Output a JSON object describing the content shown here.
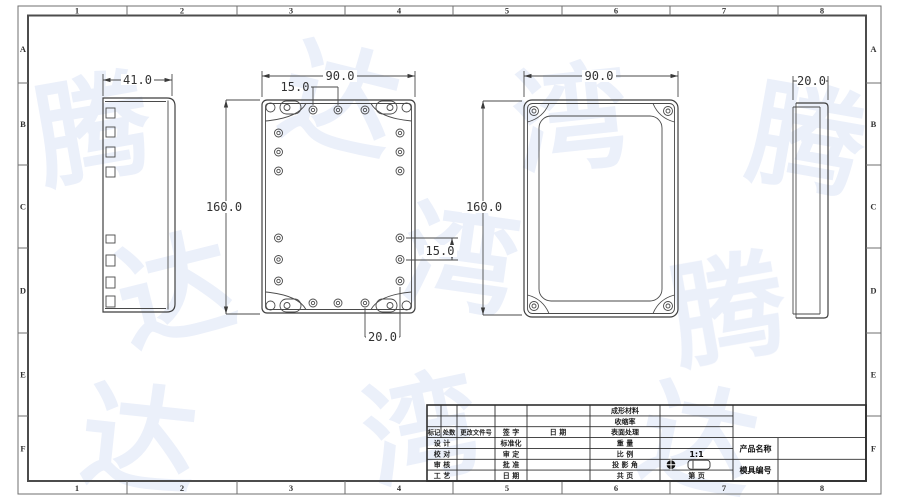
{
  "frame": {
    "columns": [
      "1",
      "2",
      "3",
      "4",
      "5",
      "6",
      "7",
      "8"
    ],
    "rows": [
      "A",
      "B",
      "C",
      "D",
      "E",
      "F"
    ]
  },
  "watermark": {
    "chars": [
      "腾",
      "达",
      "湾",
      "腾",
      "达",
      "湾",
      "腾",
      "达",
      "湾",
      "达"
    ]
  },
  "views": {
    "side_left": {
      "width_dim": "41.0"
    },
    "base": {
      "width_dim": "90.0",
      "height_dim": "160.0",
      "hole_pitch_top": "15.0",
      "hole_pitch_right": "15.0",
      "hole_offset_bottom": "20.0"
    },
    "lid": {
      "width_dim": "90.0",
      "height_dim": "160.0"
    },
    "side_right": {
      "width_dim": "20.0"
    }
  },
  "title_block": {
    "rev_headers": [
      "标记",
      "处数",
      "更改文件号",
      "签  字",
      "日  期"
    ],
    "sign_left": [
      "设  计",
      "校  对",
      "审  核",
      "工  艺"
    ],
    "sign_mid": [
      "标准化",
      "审  定",
      "批  准",
      "日  期"
    ],
    "spec_labels": [
      "成形材料",
      "收缩率",
      "表面处理",
      "重  量",
      "比  例",
      "投 影 角",
      "共  页"
    ],
    "scale_value": "1:1",
    "sheet_value": "第  页",
    "product_label": "产品名称",
    "mold_label": "模具编号"
  }
}
